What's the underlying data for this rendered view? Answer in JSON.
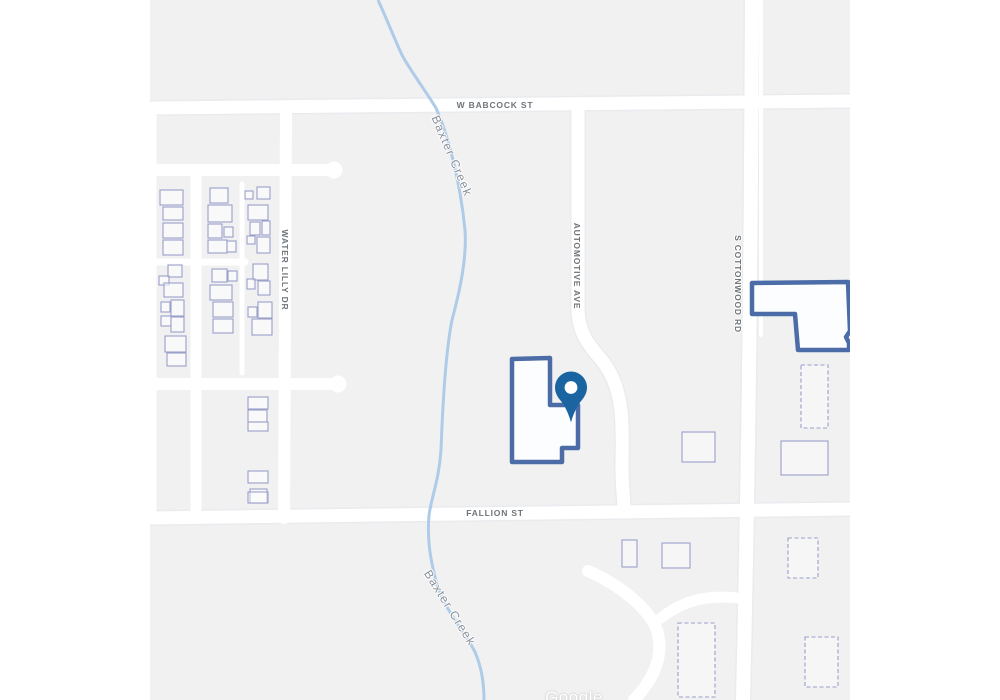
{
  "page": {
    "kind": "map-screenshot",
    "width": 1000,
    "height": 700
  },
  "map": {
    "provider": {
      "watermark": "Google"
    },
    "colors": {
      "margin": "#ffffff",
      "land": "#f1f1f2",
      "road": "#ffffff",
      "road_casing": "#e9ebee",
      "water": "#aecbe8",
      "street_label": "#6f7478",
      "water_label": "#878f99",
      "selected_building_outline": "#4b6ca6",
      "building_outline": "#9aa0ca",
      "pin": "#1a65a1"
    },
    "streets": {
      "babcock": "W BABCOCK ST",
      "fallion": "FALLION ST",
      "water_lilly": "WATER LILLY DR",
      "automotive": "AUTOMOTIVE AVE",
      "cottonwood": "S COTTONWOOD RD"
    },
    "water": {
      "creek": "Baxter Creek"
    },
    "marker": {
      "type": "location-pin",
      "color": "#1a65a1"
    },
    "selected_parcels": [
      {
        "shape": "M602,283 L698,282 L700,331 L696,337 L699,343 L699,350 L648,350 L645,314 L602,314 Z"
      },
      {
        "shape": "M362,359 L400,358 L400,405 L428,405 L428,448 L412,448 L412,462 L362,462 Z"
      }
    ],
    "houses": [
      [
        10,
        190,
        23,
        15
      ],
      [
        13,
        207,
        20,
        13
      ],
      [
        13,
        223,
        20,
        15
      ],
      [
        13,
        240,
        20,
        15
      ],
      [
        18,
        265,
        14,
        12
      ],
      [
        9,
        276,
        10,
        9
      ],
      [
        14,
        283,
        19,
        14
      ],
      [
        11,
        302,
        9,
        10
      ],
      [
        21,
        300,
        13,
        16
      ],
      [
        11,
        316,
        10,
        10
      ],
      [
        21,
        317,
        13,
        15
      ],
      [
        15,
        336,
        21,
        16
      ],
      [
        17,
        353,
        19,
        13
      ],
      [
        60,
        188,
        18,
        15
      ],
      [
        58,
        205,
        24,
        17
      ],
      [
        58,
        224,
        14,
        14
      ],
      [
        74,
        227,
        9,
        10
      ],
      [
        58,
        240,
        19,
        13
      ],
      [
        77,
        241,
        9,
        11
      ],
      [
        62,
        269,
        15,
        13
      ],
      [
        78,
        271,
        9,
        10
      ],
      [
        60,
        285,
        22,
        15
      ],
      [
        63,
        302,
        20,
        15
      ],
      [
        63,
        319,
        20,
        14
      ],
      [
        107,
        187,
        13,
        12
      ],
      [
        95,
        191,
        8,
        8
      ],
      [
        98,
        205,
        20,
        15
      ],
      [
        100,
        222,
        10,
        13
      ],
      [
        112,
        221,
        8,
        14
      ],
      [
        97,
        236,
        8,
        8
      ],
      [
        107,
        237,
        13,
        16
      ],
      [
        103,
        264,
        15,
        16
      ],
      [
        97,
        279,
        8,
        10
      ],
      [
        108,
        281,
        12,
        14
      ],
      [
        98,
        307,
        9,
        10
      ],
      [
        108,
        302,
        14,
        16
      ],
      [
        102,
        319,
        20,
        16
      ],
      [
        98,
        397,
        20,
        12
      ],
      [
        98,
        410,
        19,
        12
      ],
      [
        98,
        422,
        20,
        9
      ],
      [
        98,
        471,
        20,
        12
      ],
      [
        100,
        489,
        17,
        14
      ]
    ],
    "outbuildings": [
      {
        "x": 651,
        "y": 365,
        "w": 27,
        "h": 63,
        "d": true
      },
      {
        "x": 631,
        "y": 441,
        "w": 47,
        "h": 34,
        "d": false
      },
      {
        "x": 638,
        "y": 538,
        "w": 30,
        "h": 40,
        "d": true
      },
      {
        "x": 655,
        "y": 637,
        "w": 33,
        "h": 50,
        "d": true
      },
      {
        "x": 528,
        "y": 623,
        "w": 37,
        "h": 74,
        "d": true
      },
      {
        "x": 532,
        "y": 432,
        "w": 33,
        "h": 30,
        "d": false
      },
      {
        "x": 472,
        "y": 540,
        "w": 15,
        "h": 27,
        "d": false
      },
      {
        "x": 512,
        "y": 543,
        "w": 28,
        "h": 25,
        "d": false
      },
      {
        "x": 98,
        "y": 492,
        "w": 20,
        "h": 11,
        "d": false
      }
    ]
  }
}
